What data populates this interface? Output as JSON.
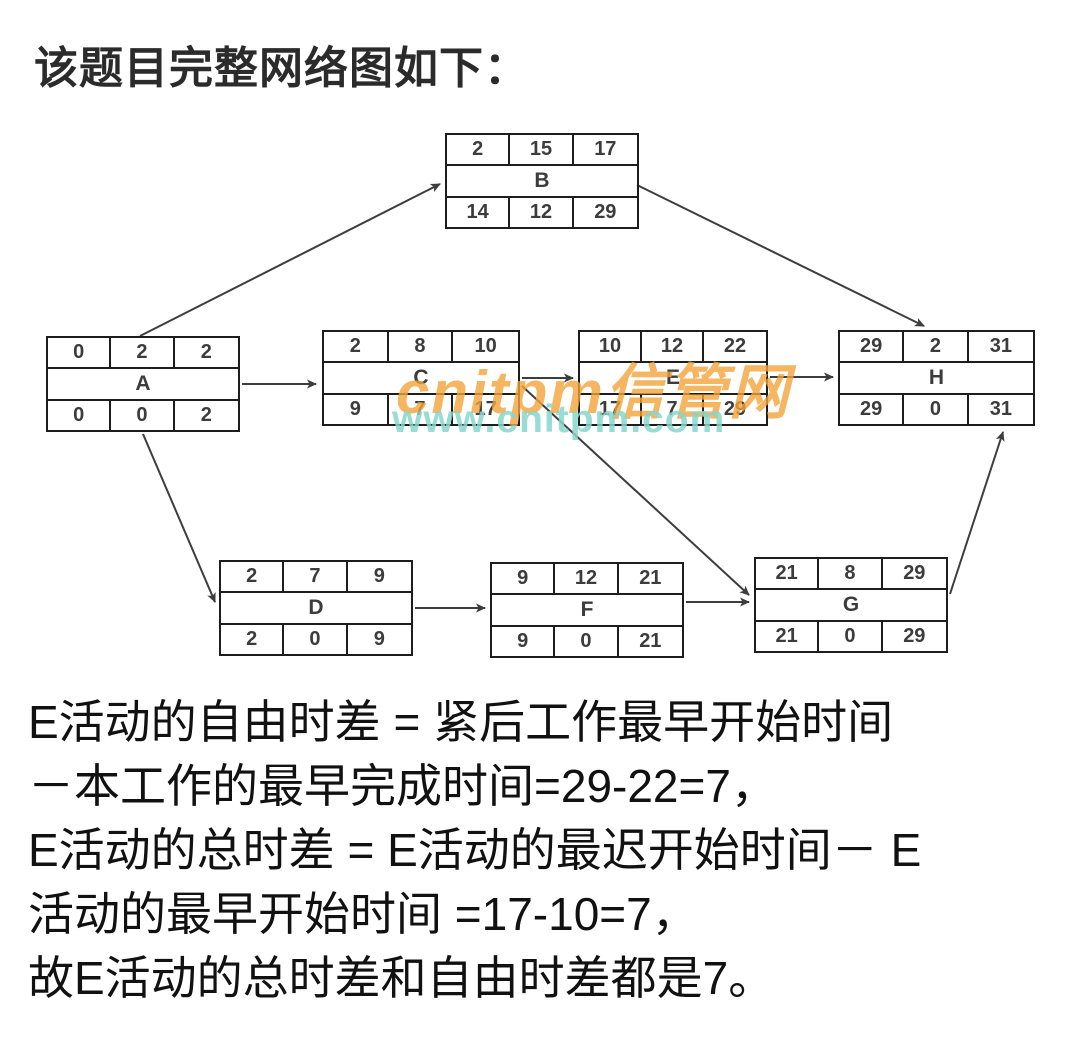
{
  "title": "该题目完整网络图如下：",
  "diagram": {
    "type": "activity-network-diagram",
    "cell_semantics": [
      "early-start",
      "duration-or-float",
      "early/late-finish"
    ],
    "nodes": {
      "A": {
        "label": "A",
        "top": [
          "0",
          "2",
          "2"
        ],
        "bottom": [
          "0",
          "0",
          "2"
        ]
      },
      "B": {
        "label": "B",
        "top": [
          "2",
          "15",
          "17"
        ],
        "bottom": [
          "14",
          "12",
          "29"
        ]
      },
      "C": {
        "label": "C",
        "top": [
          "2",
          "8",
          "10"
        ],
        "bottom": [
          "9",
          "7",
          "17"
        ]
      },
      "D": {
        "label": "D",
        "top": [
          "2",
          "7",
          "9"
        ],
        "bottom": [
          "2",
          "0",
          "9"
        ]
      },
      "E": {
        "label": "E",
        "top": [
          "10",
          "12",
          "22"
        ],
        "bottom": [
          "17",
          "7",
          "29"
        ]
      },
      "F": {
        "label": "F",
        "top": [
          "9",
          "12",
          "21"
        ],
        "bottom": [
          "9",
          "0",
          "21"
        ]
      },
      "G": {
        "label": "G",
        "top": [
          "21",
          "8",
          "29"
        ],
        "bottom": [
          "21",
          "0",
          "29"
        ]
      },
      "H": {
        "label": "H",
        "top": [
          "29",
          "2",
          "31"
        ],
        "bottom": [
          "29",
          "0",
          "31"
        ]
      }
    },
    "edges": [
      "A→B",
      "A→C",
      "A→D",
      "B→H",
      "C→E",
      "C→G",
      "D→F",
      "E→H",
      "F→G",
      "G→H"
    ]
  },
  "watermark": {
    "line1": "cnitpm信管网",
    "line2": "www.cnitpm.com",
    "color_orange": "#F3A33A",
    "color_teal": "#86D6CC"
  },
  "explanation": {
    "lines": [
      "E活动的自由时差 = 紧后工作最早开始时间",
      "－本工作的最早完成时间=29-22=7，",
      "E活动的总时差 = E活动的最迟开始时间－ E",
      "活动的最早开始时间 =17-10=7，",
      "故E活动的总时差和自由时差都是7。"
    ]
  }
}
